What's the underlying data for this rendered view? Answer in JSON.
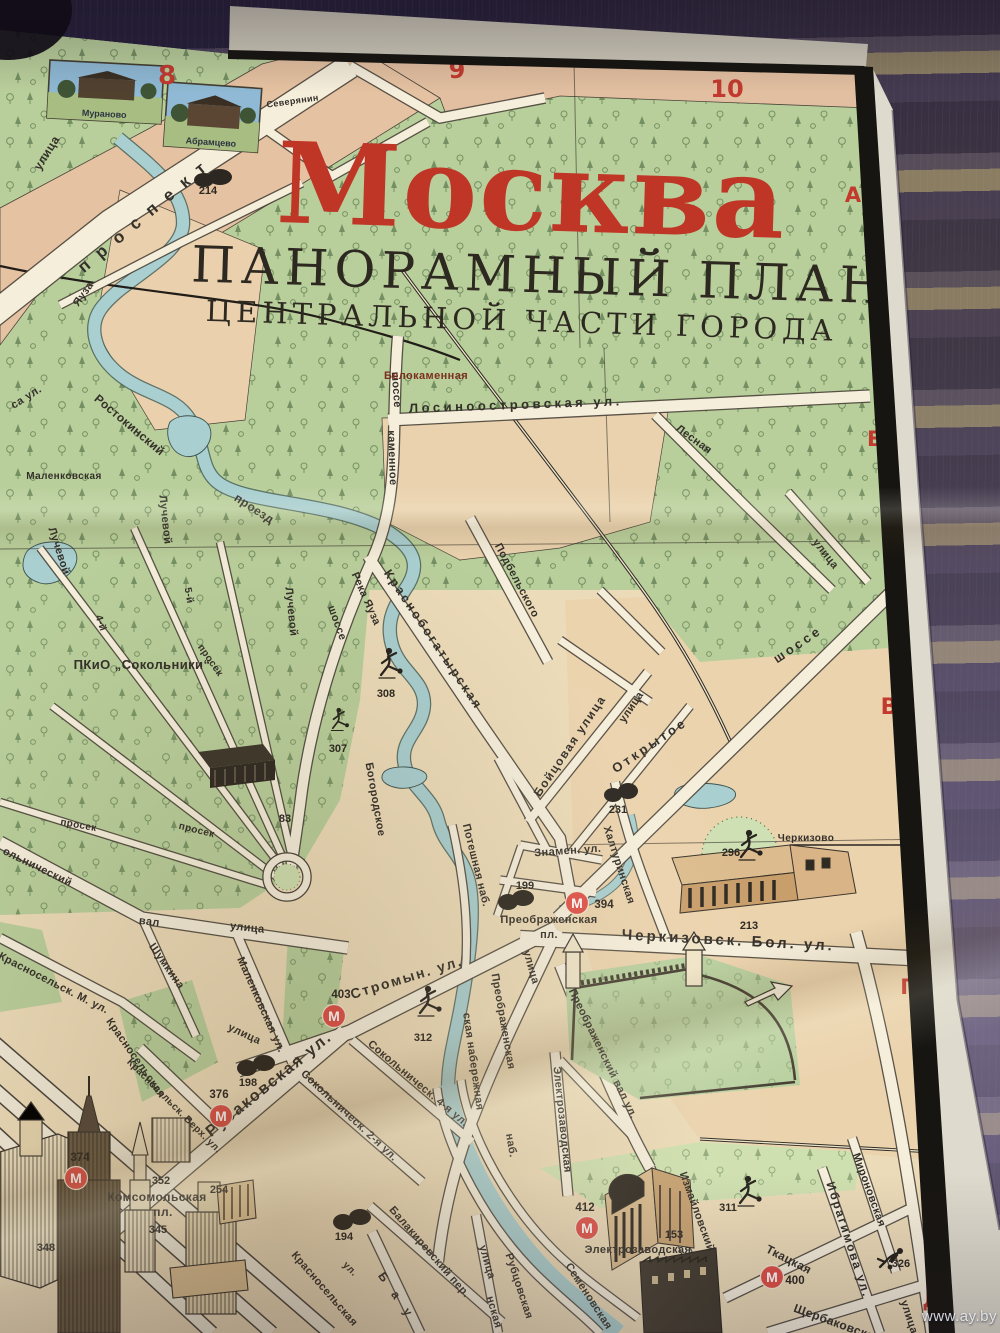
{
  "photo": {
    "watermark": "www.ay.by"
  },
  "map": {
    "title": {
      "city": "Москва",
      "subtitle": "ПАНОРАМНЫЙ ПЛАН",
      "subtitle2": "ЦЕНТРАЛЬНОЙ ЧАСТИ ГОРОДА"
    },
    "colors": {
      "paper": "#e8d7b2",
      "park": "#b9cf9b",
      "water": "#a9cfd0",
      "road": "#f5eedb",
      "accent_red": "#c23a2e",
      "metro_red": "#e05048",
      "ink": "#34302a"
    },
    "grid": {
      "columns": [
        {
          "label": "8",
          "x": 167,
          "y": 84,
          "s": 26
        },
        {
          "label": "9",
          "x": 457,
          "y": 78,
          "s": 24
        },
        {
          "label": "10",
          "x": 727,
          "y": 97,
          "s": 24
        }
      ],
      "rows": [
        {
          "label": "А",
          "x": 853,
          "y": 202,
          "s": 21
        },
        {
          "label": "Б",
          "x": 875,
          "y": 446,
          "s": 21
        },
        {
          "label": "В",
          "x": 889,
          "y": 714,
          "s": 22
        },
        {
          "label": "Г",
          "x": 907,
          "y": 994,
          "s": 21
        },
        {
          "label": "Д",
          "x": 932,
          "y": 1307,
          "s": 22
        }
      ]
    },
    "insets": [
      {
        "label": "Мураново"
      },
      {
        "label": "Абрамцево"
      }
    ],
    "metro_symbol": "М",
    "metro_stations": [
      {
        "number": "374",
        "x": 76,
        "y": 1178,
        "nx": 80,
        "ny": 1161
      },
      {
        "number": "376",
        "x": 221,
        "y": 1116,
        "nx": 219,
        "ny": 1098
      },
      {
        "number": "403",
        "x": 334,
        "y": 1016,
        "nx": 341,
        "ny": 998
      },
      {
        "number": "394",
        "x": 577,
        "y": 903,
        "nx": 604,
        "ny": 908
      },
      {
        "number": "412",
        "x": 587,
        "y": 1228,
        "nx": 585,
        "ny": 1211
      },
      {
        "number": "400",
        "x": 772,
        "y": 1277,
        "nx": 795,
        "ny": 1284
      }
    ],
    "poi_numbers": [
      {
        "n": "214",
        "x": 208,
        "y": 194
      },
      {
        "n": "308",
        "x": 386,
        "y": 697
      },
      {
        "n": "307",
        "x": 338,
        "y": 752
      },
      {
        "n": "83",
        "x": 285,
        "y": 822
      },
      {
        "n": "231",
        "x": 618,
        "y": 813
      },
      {
        "n": "296",
        "x": 731,
        "y": 856
      },
      {
        "n": "213",
        "x": 749,
        "y": 929
      },
      {
        "n": "199",
        "x": 525,
        "y": 889
      },
      {
        "n": "198",
        "x": 248,
        "y": 1086
      },
      {
        "n": "312",
        "x": 423,
        "y": 1041
      },
      {
        "n": "352",
        "x": 161,
        "y": 1184
      },
      {
        "n": "254",
        "x": 219,
        "y": 1193
      },
      {
        "n": "345",
        "x": 158,
        "y": 1233
      },
      {
        "n": "348",
        "x": 46,
        "y": 1251
      },
      {
        "n": "194",
        "x": 344,
        "y": 1240
      },
      {
        "n": "153",
        "x": 674,
        "y": 1238
      },
      {
        "n": "311",
        "x": 728,
        "y": 1211
      },
      {
        "n": "326",
        "x": 901,
        "y": 1267
      }
    ],
    "street_labels": [
      {
        "t": "Северянин",
        "x": 293,
        "y": 104,
        "r": -8,
        "s": 9
      },
      {
        "t": "улица",
        "x": 50,
        "y": 155,
        "r": -58,
        "s": 12
      },
      {
        "t": "проспект",
        "x": 150,
        "y": 218,
        "r": -40,
        "s": 17,
        "sp": 12
      },
      {
        "t": "Яуза",
        "x": 86,
        "y": 296,
        "r": -55,
        "s": 11
      },
      {
        "t": "са ул.",
        "x": 28,
        "y": 400,
        "r": -32,
        "s": 11
      },
      {
        "t": "Ростокинский",
        "x": 127,
        "y": 428,
        "r": 40,
        "s": 12
      },
      {
        "t": "проезд",
        "x": 252,
        "y": 512,
        "r": 33,
        "s": 12
      },
      {
        "t": "Маленковская",
        "x": 64,
        "y": 479,
        "r": 0,
        "s": 10
      },
      {
        "t": "Лучевой",
        "x": 56,
        "y": 552,
        "r": 72,
        "s": 11
      },
      {
        "t": "Лучевой",
        "x": 162,
        "y": 520,
        "r": 84,
        "s": 11
      },
      {
        "t": "Лучевой",
        "x": 288,
        "y": 612,
        "r": 84,
        "s": 11
      },
      {
        "t": "5-й",
        "x": 186,
        "y": 596,
        "r": 80,
        "s": 10
      },
      {
        "t": "просек",
        "x": 208,
        "y": 662,
        "r": 55,
        "s": 10
      },
      {
        "t": "4-й",
        "x": 98,
        "y": 624,
        "r": 72,
        "s": 10
      },
      {
        "t": "ПКиО „Сокольники“",
        "x": 142,
        "y": 669,
        "r": 0,
        "s": 13
      },
      {
        "t": "просек",
        "x": 78,
        "y": 828,
        "r": 10,
        "s": 10
      },
      {
        "t": "просек",
        "x": 196,
        "y": 833,
        "r": 14,
        "s": 10
      },
      {
        "t": "ольнический",
        "x": 36,
        "y": 870,
        "r": 26,
        "s": 11
      },
      {
        "t": "вал",
        "x": 149,
        "y": 925,
        "r": 6,
        "s": 11
      },
      {
        "t": "улица",
        "x": 247,
        "y": 931,
        "r": 6,
        "s": 11
      },
      {
        "t": "Шумкина",
        "x": 164,
        "y": 968,
        "r": 55,
        "s": 11
      },
      {
        "t": "Маленковская ул.",
        "x": 258,
        "y": 1006,
        "r": 66,
        "s": 11
      },
      {
        "t": "улица",
        "x": 243,
        "y": 1037,
        "r": 25,
        "s": 11
      },
      {
        "t": "Красносельск. М. ул.",
        "x": 52,
        "y": 986,
        "r": 27,
        "s": 11
      },
      {
        "t": "Красносельская",
        "x": 133,
        "y": 1060,
        "r": 55,
        "s": 11
      },
      {
        "t": "Красносельск. Верх. ул.",
        "x": 172,
        "y": 1108,
        "r": 45,
        "s": 10
      },
      {
        "t": "шоссе",
        "x": 393,
        "y": 390,
        "r": 86,
        "s": 11
      },
      {
        "t": "каменное",
        "x": 389,
        "y": 458,
        "r": 88,
        "s": 11
      },
      {
        "t": "шоссе",
        "x": 334,
        "y": 624,
        "r": 70,
        "s": 11
      },
      {
        "t": "Белокаменная",
        "x": 426,
        "y": 379,
        "r": 0,
        "s": 11,
        "c": "#7c2f1f"
      },
      {
        "t": "Лосиноостровская ул.",
        "x": 516,
        "y": 409,
        "r": -2,
        "s": 13,
        "sp": 3.5
      },
      {
        "t": "Лесная",
        "x": 692,
        "y": 442,
        "r": 36,
        "s": 11
      },
      {
        "t": "улица",
        "x": 823,
        "y": 556,
        "r": 52,
        "s": 11
      },
      {
        "t": "Подбельского",
        "x": 514,
        "y": 582,
        "r": 62,
        "s": 11
      },
      {
        "t": "Река Яуза",
        "x": 363,
        "y": 600,
        "r": 66,
        "s": 11
      },
      {
        "t": "Краснобогатырская",
        "x": 430,
        "y": 642,
        "r": 56,
        "s": 12.5,
        "sp": 2.5
      },
      {
        "t": "Богородское",
        "x": 372,
        "y": 800,
        "r": 80,
        "s": 11
      },
      {
        "t": "Бойцовая улица",
        "x": 573,
        "y": 748,
        "r": -56,
        "s": 12,
        "sp": 1.5
      },
      {
        "t": "улица",
        "x": 634,
        "y": 709,
        "r": -56,
        "s": 11
      },
      {
        "t": "Открытое",
        "x": 652,
        "y": 749,
        "r": -34,
        "s": 13,
        "sp": 3
      },
      {
        "t": "шоссе",
        "x": 800,
        "y": 648,
        "r": -34,
        "s": 13,
        "sp": 3
      },
      {
        "t": "Халтуринская",
        "x": 616,
        "y": 866,
        "r": 72,
        "s": 11
      },
      {
        "t": "Черкизово",
        "x": 806,
        "y": 841,
        "r": 0,
        "s": 10
      },
      {
        "t": "Знамен. ул.",
        "x": 568,
        "y": 854,
        "r": -4,
        "s": 11
      },
      {
        "t": "Преображенская",
        "x": 549,
        "y": 923,
        "r": 0,
        "s": 11
      },
      {
        "t": "пл.",
        "x": 549,
        "y": 938,
        "r": 0,
        "s": 11
      },
      {
        "t": "Черкизовск. Бол. ул.",
        "x": 728,
        "y": 945,
        "r": 3,
        "s": 15,
        "sp": 3
      },
      {
        "t": "Потешная наб.",
        "x": 473,
        "y": 866,
        "r": 76,
        "s": 11
      },
      {
        "t": "улица",
        "x": 528,
        "y": 968,
        "r": 74,
        "s": 11
      },
      {
        "t": "Преображенская",
        "x": 500,
        "y": 1022,
        "r": 80,
        "s": 11
      },
      {
        "t": "ская набережная",
        "x": 470,
        "y": 1062,
        "r": 82,
        "s": 11
      },
      {
        "t": "наб.",
        "x": 508,
        "y": 1146,
        "r": 80,
        "s": 11
      },
      {
        "t": "Преображенский вал ул.",
        "x": 600,
        "y": 1055,
        "r": 64,
        "s": 11
      },
      {
        "t": "Электрозаводская",
        "x": 559,
        "y": 1120,
        "r": 84,
        "s": 11
      },
      {
        "t": "Стромын. ул.",
        "x": 408,
        "y": 982,
        "r": -17,
        "s": 14,
        "sp": 2
      },
      {
        "t": "Сокольническ. 2-я ул.",
        "x": 347,
        "y": 1118,
        "r": 43,
        "s": 11
      },
      {
        "t": "Сокольническ. 4-я ул.",
        "x": 416,
        "y": 1086,
        "r": 40,
        "s": 11
      },
      {
        "t": "Русаковская ул.",
        "x": 272,
        "y": 1088,
        "r": -39,
        "s": 16,
        "sp": 2
      },
      {
        "t": "Комсомольская",
        "x": 157,
        "y": 1201,
        "r": 0,
        "s": 12
      },
      {
        "t": "пл.",
        "x": 163,
        "y": 1216,
        "r": 0,
        "s": 12
      },
      {
        "t": "Балакиревский пер.",
        "x": 427,
        "y": 1254,
        "r": 49,
        "s": 11
      },
      {
        "t": "улица",
        "x": 484,
        "y": 1263,
        "r": 74,
        "s": 11
      },
      {
        "t": "нская",
        "x": 491,
        "y": 1313,
        "r": 74,
        "s": 11
      },
      {
        "t": "Бау",
        "x": 396,
        "y": 1302,
        "r": 55,
        "s": 12,
        "sp": 14
      },
      {
        "t": "Красносельская",
        "x": 322,
        "y": 1291,
        "r": 49,
        "s": 11
      },
      {
        "t": "ул.",
        "x": 348,
        "y": 1271,
        "r": 45,
        "s": 10
      },
      {
        "t": "Рубцовская",
        "x": 516,
        "y": 1287,
        "r": 72,
        "s": 11
      },
      {
        "t": "Семеновская",
        "x": 586,
        "y": 1298,
        "r": 57,
        "s": 11
      },
      {
        "t": "Электрозаводская",
        "x": 638,
        "y": 1253,
        "r": 0,
        "s": 11
      },
      {
        "t": "Измайловский",
        "x": 694,
        "y": 1213,
        "r": 70,
        "s": 11
      },
      {
        "t": "Ткацкая",
        "x": 787,
        "y": 1263,
        "r": 27,
        "s": 12
      },
      {
        "t": "Щербаковская",
        "x": 836,
        "y": 1327,
        "r": 20,
        "s": 12
      },
      {
        "t": "Мироновская",
        "x": 866,
        "y": 1191,
        "r": 70,
        "s": 11
      },
      {
        "t": "Ибрагимова ул.",
        "x": 845,
        "y": 1241,
        "r": 72,
        "s": 12,
        "sp": 2
      },
      {
        "t": "улица",
        "x": 906,
        "y": 1318,
        "r": 72,
        "s": 11
      }
    ],
    "figures": [
      {
        "x": 388,
        "y": 672,
        "kind": "kicker",
        "scale": 1
      },
      {
        "x": 338,
        "y": 726,
        "kind": "kicker",
        "scale": 0.75
      },
      {
        "x": 748,
        "y": 854,
        "kind": "kicker",
        "scale": 1
      },
      {
        "x": 427,
        "y": 1010,
        "kind": "kicker",
        "scale": 1
      },
      {
        "x": 747,
        "y": 1200,
        "kind": "kicker",
        "scale": 1
      },
      {
        "x": 888,
        "y": 1258,
        "kind": "dive",
        "scale": 1
      }
    ]
  }
}
